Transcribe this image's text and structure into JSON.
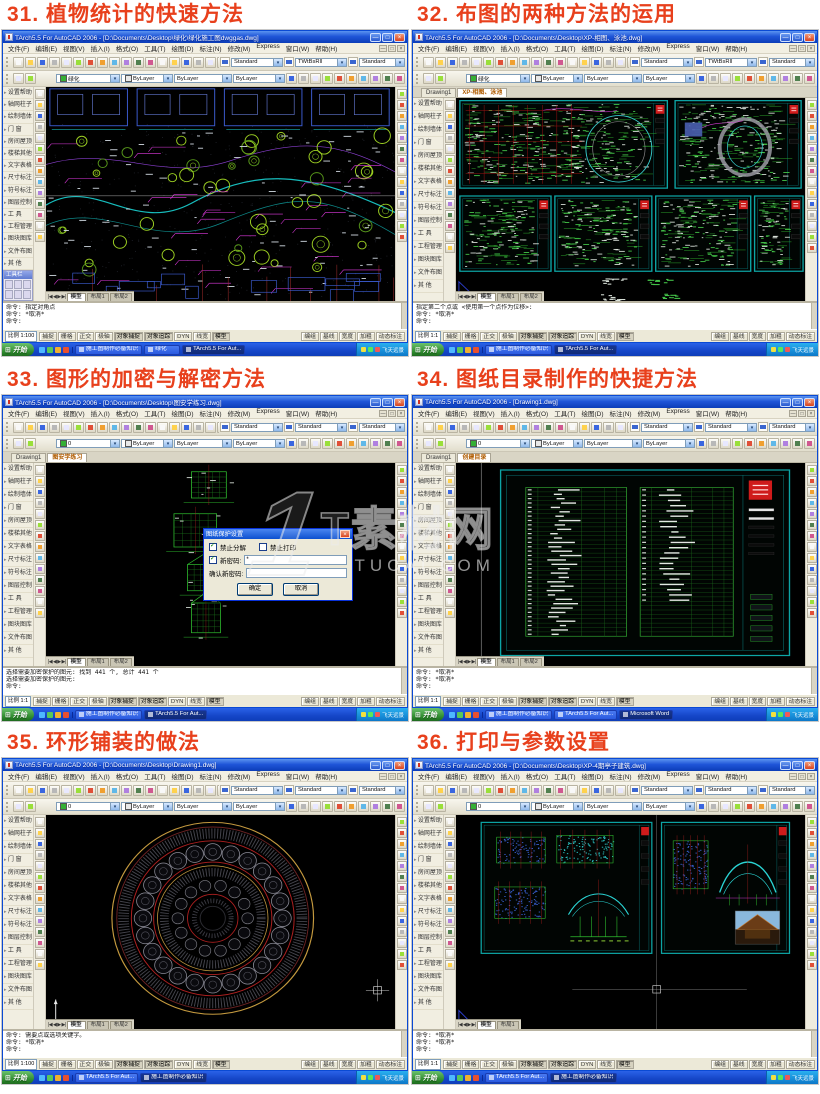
{
  "page": {
    "watermark": {
      "logo_glyph": "1",
      "brand_text": "T素材网",
      "domain": "TUCAI.COM"
    }
  },
  "chrome": {
    "menus": [
      "文件(F)",
      "编辑(E)",
      "视图(V)",
      "插入(I)",
      "格式(O)",
      "工具(T)",
      "绘图(D)",
      "标注(N)",
      "修改(M)",
      "Express",
      "窗口(W)",
      "帮助(H)"
    ],
    "window_controls": {
      "minimize": "—",
      "restore": "□",
      "close": "×"
    },
    "dropdown_glyph": "▾",
    "toolbar_icons_standard": [
      "new-file-icon",
      "open-icon",
      "save-icon",
      "print-icon",
      "plot-preview-icon",
      "publish-icon",
      "cut-icon",
      "copy-icon",
      "paste-icon",
      "match-properties-icon",
      "undo-icon",
      "redo-icon",
      "pan-icon",
      "zoom-realtime-icon",
      "zoom-window-icon",
      "zoom-previous-icon",
      "properties-icon",
      "designcenter-icon",
      "tool-palettes-icon",
      "help-icon"
    ],
    "toolbar_icons_layers": [
      "layer-properties-icon",
      "layers-icon"
    ],
    "toolbar_icons_modify": [
      "erase-icon",
      "copy-object-icon",
      "mirror-icon",
      "offset-icon",
      "array-icon",
      "move-icon",
      "rotate-icon",
      "scale-icon",
      "trim-icon",
      "fillet-icon"
    ],
    "screen_menu": [
      "设置帮助",
      "轴网柱子",
      "绘制墙体",
      "门  窗",
      "房间屋顶",
      "楼梯其他",
      "文字表格",
      "尺寸标注",
      "符号标注",
      "图层控制",
      "工  具",
      "工程管理",
      "图块图库",
      "文件布图",
      "其  他"
    ],
    "status_buttons": [
      "捕捉",
      "栅格",
      "正交",
      "极轴",
      "对象捕捉",
      "对象追踪",
      "DYN",
      "线宽",
      "模型"
    ],
    "status_pressed": [
      "对象捕捉",
      "对象追踪",
      "模型"
    ],
    "status_buttons2": [
      "编组",
      "基线",
      "宽度",
      "加粗",
      "动态标注"
    ],
    "layout_nav": "|◀ ◀ ▶ ▶|",
    "start_label": "开始",
    "tray_text": "飞天远景",
    "quick_launch_icons": [
      "ie-icon",
      "show-desktop-icon",
      "media-player-icon",
      "folder-icon"
    ],
    "tray_icons": [
      "volume-icon",
      "network-icon",
      "ime-icon"
    ]
  },
  "panels": [
    {
      "title": "31. 植物统计的快速方法",
      "window_title": "TArch5.5 For AutoCAD 2006 - [D:\\Documents\\Desktop\\绿化\\绿化施工图dwggas.dwg]",
      "canvas": "landscape",
      "combos": {
        "text_style": "Standard",
        "dim_style": "TWtBsRll",
        "table_style": "Standard",
        "layer": "绿化",
        "color": "ByLayer",
        "linetype": "ByLayer",
        "lineweight": "ByLayer"
      },
      "doc_tabs": [],
      "layout_tabs": [
        "模型",
        "布局1",
        "布局2"
      ],
      "command_lines": [
        "命令: 指定对角点",
        "命令: *取消*",
        "命令:"
      ],
      "scale": "比例 1:100",
      "tasks": [
        "施工图制作必备知识",
        "绿化",
        "TArch5.5 For Aut..."
      ],
      "palette": "工具栏"
    },
    {
      "title": "32. 布图的两种方法的运用",
      "window_title": "TArch5.5 For AutoCAD 2006 - [D:\\Documents\\Desktop\\XP-相图、泳池.dwg]",
      "canvas": "sheets",
      "combos": {
        "text_style": "Standard",
        "dim_style": "TWtBsRll",
        "table_style": "Standard",
        "layer": "绿化",
        "color": "ByLayer",
        "linetype": "ByLayer",
        "lineweight": "ByLayer"
      },
      "doc_tabs": [
        "Drawing1",
        "XP-相图、泳池"
      ],
      "layout_tabs": [
        "模型",
        "布局1",
        "布局2"
      ],
      "command_lines": [
        "指定第二个点或 <使用第一个点作为位移>:",
        "命令: *取消*",
        "命令:"
      ],
      "scale": "比例 1:1",
      "tasks": [
        "施工图制作必备知识",
        "TArch5.5 For Aut..."
      ]
    },
    {
      "title": "33. 图形的加密与解密方法",
      "window_title": "TArch5.5 For AutoCAD 2006 - [D:\\Documents\\Desktop\\图安学练习.dwg]",
      "canvas": "protect",
      "combos": {
        "text_style": "Standard",
        "dim_style": "Standard",
        "table_style": "Standard",
        "layer": "0",
        "color": "ByLayer",
        "linetype": "ByLayer",
        "lineweight": "ByLayer"
      },
      "doc_tabs": [
        "Drawing1",
        "图安学练习"
      ],
      "layout_tabs": [
        "模型",
        "布局1",
        "布局2"
      ],
      "command_lines": [
        "选择需要加密保护的图元: 找到 441 个, 总计 441 个",
        "选择需要加密保护的图元:",
        "命令:"
      ],
      "scale": "比例 1:1",
      "tasks": [
        "施工图制作必备知识",
        "TArch5.5 For Aut..."
      ],
      "dialog": {
        "title": "图纸保护设置",
        "checkbox1": "禁止分解",
        "checkbox2": "禁止打印",
        "password_label": "新密码:",
        "password_value": "*",
        "confirm_label": "确认新密码:",
        "confirm_value": "",
        "ok": "确定",
        "cancel": "取消"
      }
    },
    {
      "title": "34. 图纸目录制作的快捷方法",
      "window_title": "TArch5.5 For AutoCAD 2006 - [Drawing1.dwg]",
      "canvas": "catalog",
      "combos": {
        "text_style": "Standard",
        "dim_style": "Standard",
        "table_style": "Standard",
        "layer": "0",
        "color": "ByLayer",
        "linetype": "ByLayer",
        "lineweight": "ByLayer"
      },
      "doc_tabs": [
        "Drawing1",
        "创建目录"
      ],
      "layout_tabs": [
        "模型",
        "布局1",
        "布局2"
      ],
      "command_lines": [
        "命令: *取消*",
        "命令: *取消*",
        "命令:"
      ],
      "scale": "比例 1:1",
      "tasks": [
        "施工图制作必备知识",
        "TArch5.5 For Aut...",
        "Microsoft Word"
      ]
    },
    {
      "title": "35. 环形铺装的做法",
      "window_title": "TArch5.5 For AutoCAD 2006 - [D:\\Documents\\Desktop\\Drawing1.dwg]",
      "canvas": "rings",
      "combos": {
        "text_style": "Standard",
        "dim_style": "Standard",
        "table_style": "Standard",
        "layer": "0",
        "color": "ByLayer",
        "linetype": "ByLayer",
        "lineweight": "ByLayer"
      },
      "doc_tabs": [],
      "layout_tabs": [
        "模型",
        "布局1",
        "布局2"
      ],
      "command_lines": [
        "命令: 需要点或选项关键字。",
        "命令: *取消*",
        "命令:"
      ],
      "scale": "比例 1:100",
      "tasks": [
        "TArch5.5 For Aut...",
        "施工图制作必备知识"
      ]
    },
    {
      "title": "36. 打印与参数设置",
      "window_title": "TArch5.5 For AutoCAD 2006 - [D:\\Documents\\Desktop\\XP-4期亭子建筑.dwg]",
      "canvas": "pavilion",
      "combos": {
        "text_style": "Standard",
        "dim_style": "Standard",
        "table_style": "Standard",
        "layer": "0",
        "color": "ByLayer",
        "linetype": "ByLayer",
        "lineweight": "ByLayer"
      },
      "doc_tabs": [],
      "layout_tabs": [
        "模型",
        "布局1"
      ],
      "command_lines": [
        "命令: *取消*",
        "命令: *取消*",
        "命令:"
      ],
      "scale": "比例 1:1",
      "tasks": [
        "TArch5.5 For Aut...",
        "施工图制作必备知识"
      ]
    }
  ]
}
